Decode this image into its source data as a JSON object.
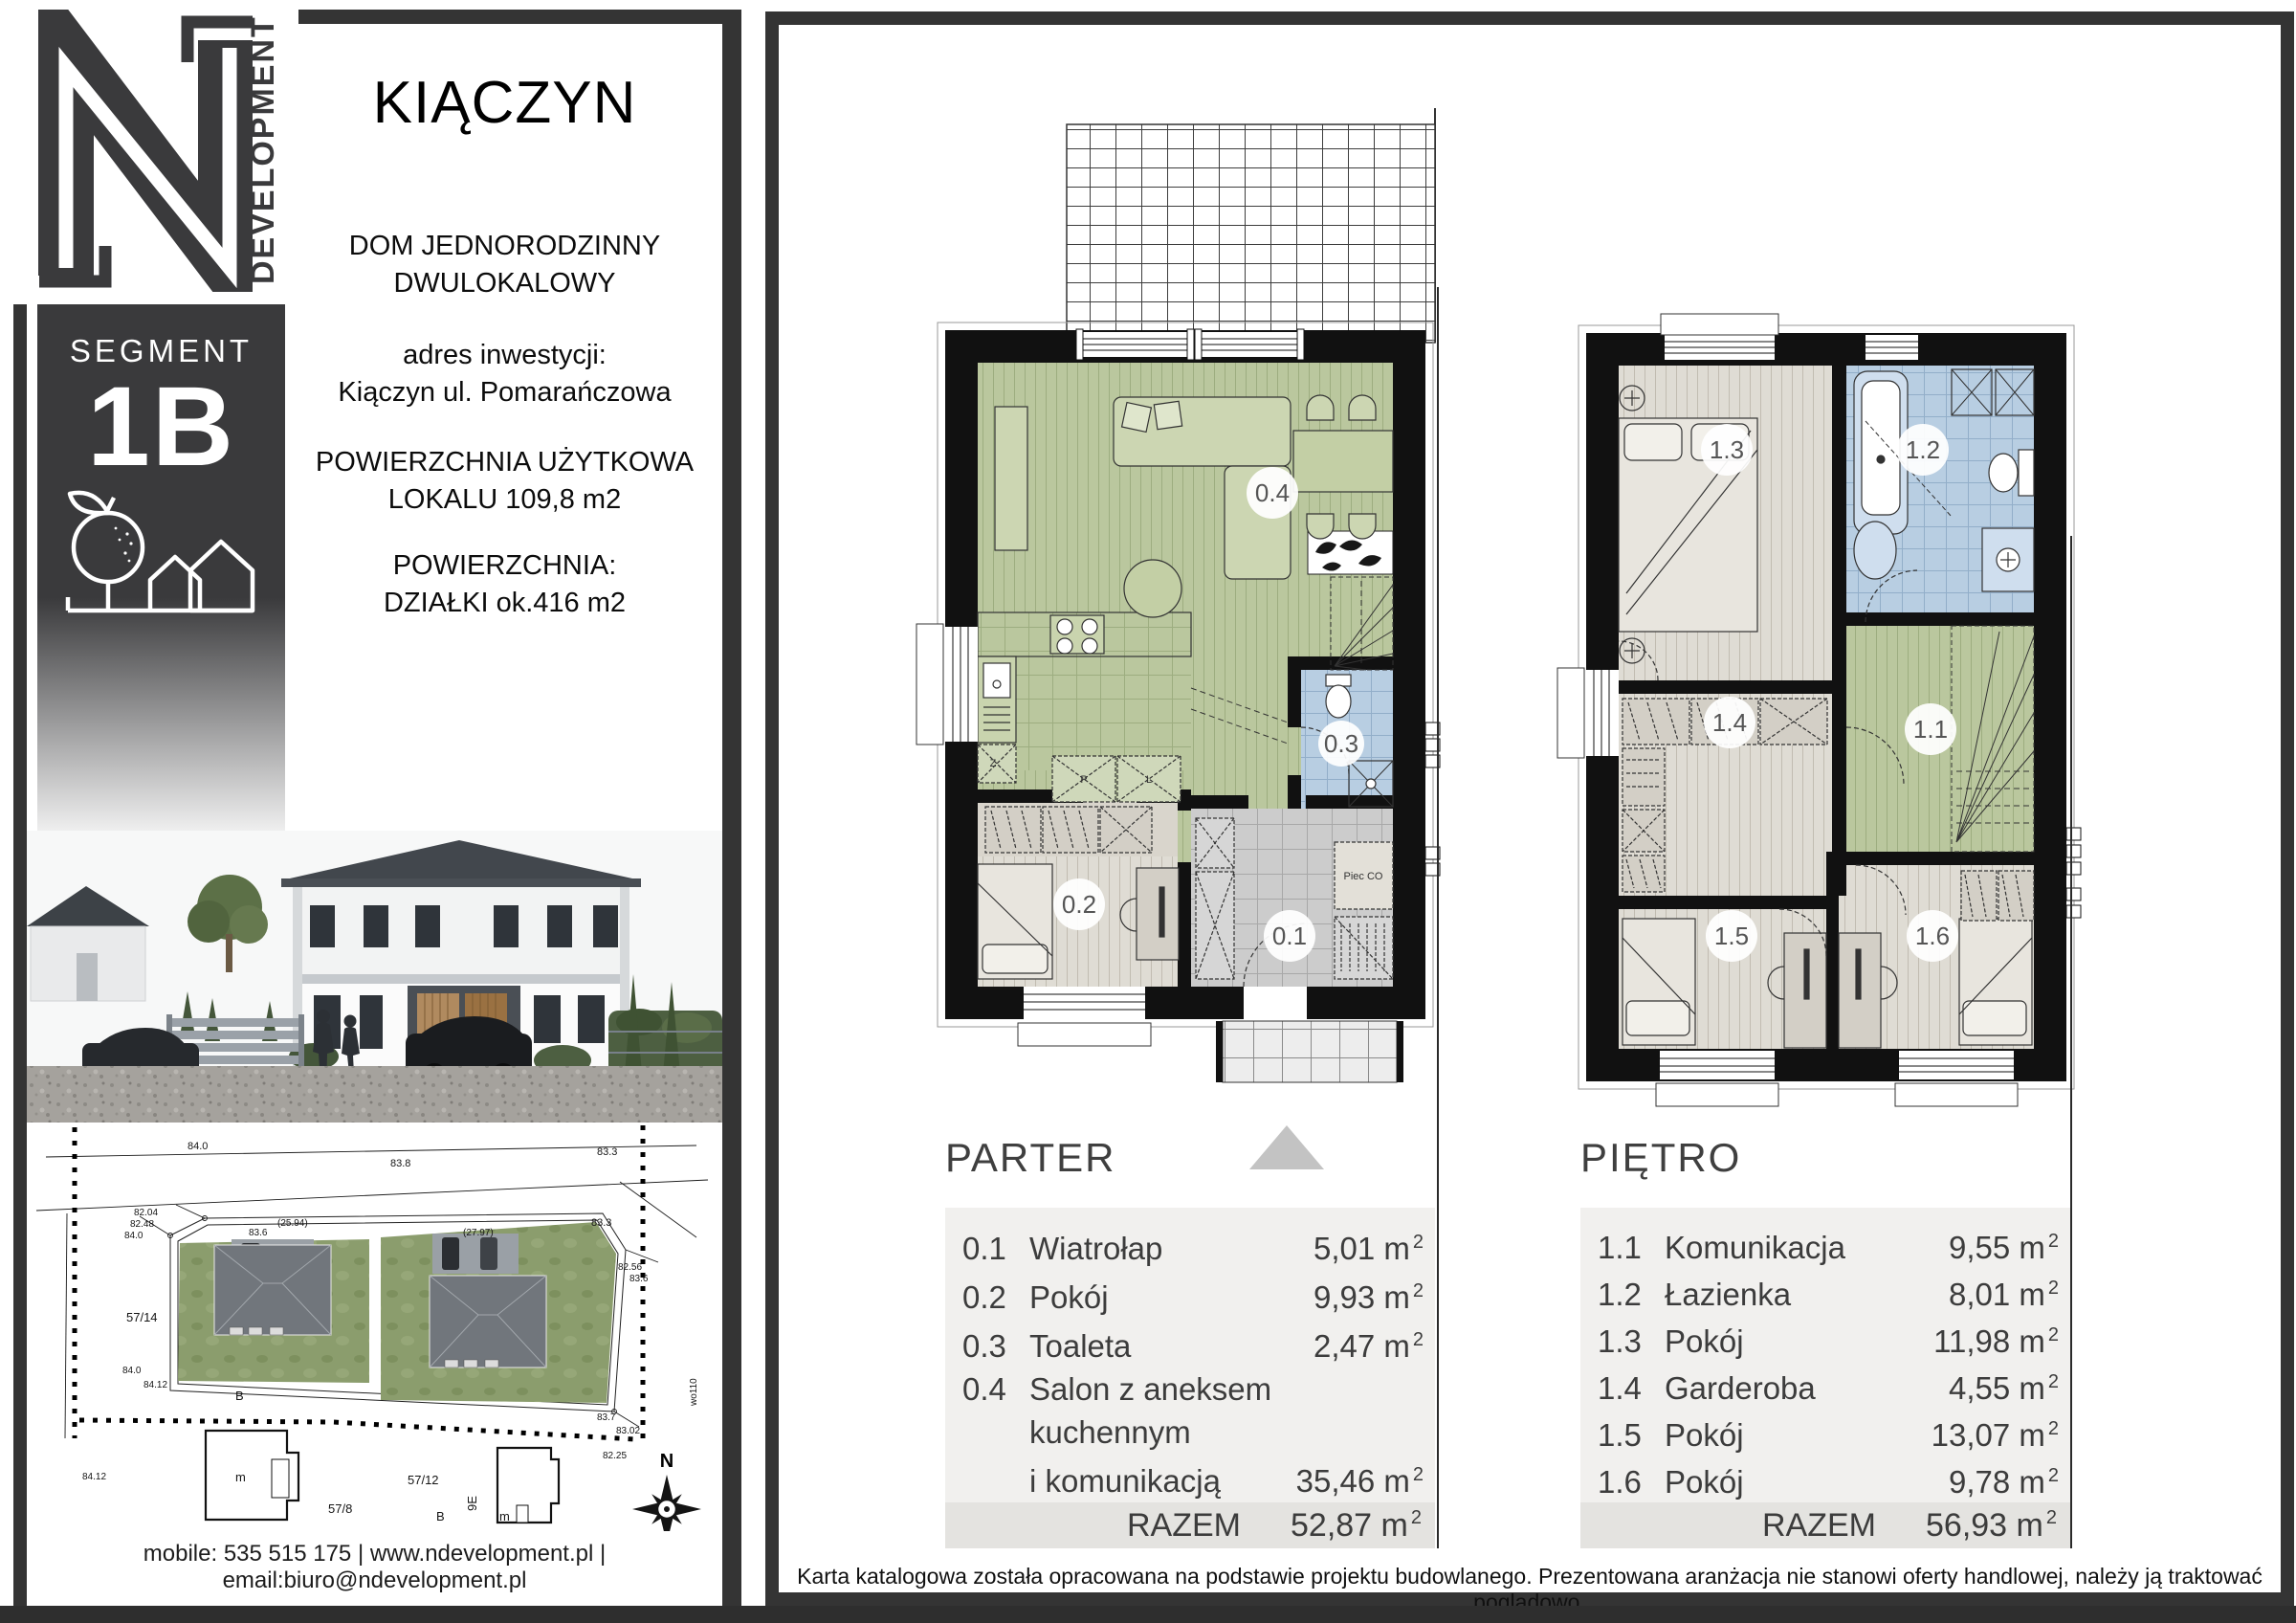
{
  "colors": {
    "brand_dark": "#3a3a3c",
    "wall": "#111111",
    "floor_green": "#bac79e",
    "floor_beige": "#dfdcd4",
    "floor_blue": "#b8cee2",
    "floor_gray": "#cccccc",
    "list_bg": "#f1f0ee",
    "total_bg": "#e4e3e0",
    "north_triangle": "#c3c3c3"
  },
  "logo": {
    "letter": "N",
    "word": "DEVELOPMENT"
  },
  "badge": {
    "label": "SEGMENT",
    "value": "1B"
  },
  "info": {
    "title": "KIĄCZYN",
    "type_line1": "DOM JEDNORODZINNY",
    "type_line2": "DWULOKALOWY",
    "address_label": "adres inwestycji:",
    "address_value": "Kiączyn ul. Pomarańczowa",
    "area1_label": "POWIERZCHNIA UŻYTKOWA",
    "area1_value": "LOKALU 109,8 m2",
    "area2_label": "POWIERZCHNIA:",
    "area2_value": "DZIAŁKI ok.416 m2"
  },
  "contact": {
    "line": "mobile: 535 515 175  |  www.ndevelopment.pl  |  email:biuro@ndevelopment.pl"
  },
  "unit": {
    "m": "m",
    "sup": "2"
  },
  "floors": {
    "parter": {
      "label": "PARTER",
      "total_label": "RAZEM",
      "total": "52,87",
      "rooms": [
        {
          "num": "0.1",
          "name": "Wiatrołap",
          "area": "5,01"
        },
        {
          "num": "0.2",
          "name": "Pokój",
          "area": "9,93"
        },
        {
          "num": "0.3",
          "name": "Toaleta",
          "area": "2,47"
        },
        {
          "num": "0.4",
          "name": "Salon z aneksem kuchennym",
          "name2": "i komunikacją",
          "area": "35,46"
        }
      ]
    },
    "pietro": {
      "label": "PIĘTRO",
      "total_label": "RAZEM",
      "total": "56,93",
      "rooms": [
        {
          "num": "1.1",
          "name": "Komunikacja",
          "area": "9,55"
        },
        {
          "num": "1.2",
          "name": "Łazienka",
          "area": "8,01"
        },
        {
          "num": "1.3",
          "name": "Pokój",
          "area": "11,98"
        },
        {
          "num": "1.4",
          "name": "Garderoba",
          "area": "4,55"
        },
        {
          "num": "1.5",
          "name": "Pokój",
          "area": "13,07"
        },
        {
          "num": "1.6",
          "name": "Pokój",
          "area": "9,78"
        }
      ]
    }
  },
  "plan": {
    "parter_badges": [
      "0.1",
      "0.2",
      "0.3",
      "0.4"
    ],
    "pietro_badges": [
      "1.1",
      "1.2",
      "1.3",
      "1.4",
      "1.5",
      "1.6"
    ],
    "boiler": "Piec CO",
    "closet_p": "P",
    "closet_l": "L",
    "sink_z": "Z"
  },
  "site": {
    "dims": [
      "84.0",
      "83.8",
      "83.3",
      "82.04",
      "82.48",
      "84.0",
      "(25.94)",
      "83.6",
      "(27.97)",
      "82.56",
      "83.6",
      "83.3",
      "84.0",
      "84.12",
      "83.7",
      "83.02",
      "82.25",
      "84.12",
      "wo110"
    ],
    "plots": [
      "57/14",
      "57/12",
      "57/8"
    ],
    "marks": [
      "B",
      "m",
      "B",
      "m",
      "9E"
    ],
    "compass_n": "N"
  },
  "disclaimer": "Karta katalogowa została opracowana na podstawie projektu budowlanego. Prezentowana aranżacja nie stanowi oferty handlowej, należy ją traktować poglądowo."
}
